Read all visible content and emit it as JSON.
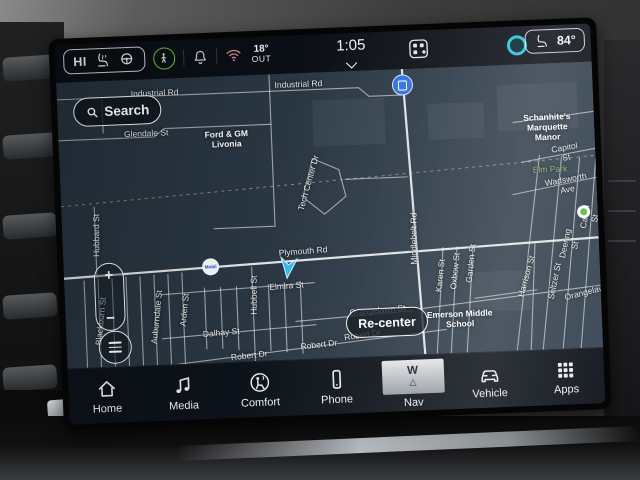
{
  "status_bar": {
    "climate_left_label": "HI",
    "outside_temp": {
      "value": "18°",
      "label": "OUT"
    },
    "time": "1:05",
    "right_temp": "84°",
    "icons": [
      "heated-seat",
      "heated-steering-wheel",
      "pedestrian-alert",
      "notification-bell",
      "wifi",
      "apps-grid",
      "voice-assistant",
      "seat"
    ]
  },
  "map": {
    "search_label": "Search",
    "recenter_label": "Re-center",
    "zoom_in_label": "+",
    "zoom_out_label": "−",
    "pois": [
      {
        "name": "Mobil",
        "type": "gas-station"
      },
      {
        "type": "blue-building-poi",
        "color": "#2e6fe0"
      },
      {
        "type": "green-park-pin",
        "color": "#5bb84a"
      }
    ],
    "colors": {
      "background": "#2b3844",
      "road": "#ffffff",
      "park_text": "#83b271",
      "cursor": "#30b8ef"
    },
    "labels": [
      {
        "t": "Industrial Rd",
        "x": 98,
        "y": 14,
        "r": 0,
        "c": "st"
      },
      {
        "t": "Industrial Rd",
        "x": 242,
        "y": 11,
        "r": 0,
        "c": "st"
      },
      {
        "t": "Glendale St",
        "x": 88,
        "y": 54,
        "r": 0,
        "c": "st"
      },
      {
        "t": "Ford & GM\nLivonia",
        "x": 168,
        "y": 63,
        "r": 0,
        "c": "poi"
      },
      {
        "t": "Hubbard St",
        "x": 34,
        "y": 154,
        "r": -88,
        "c": "st"
      },
      {
        "t": "Tech Center Dr",
        "x": 248,
        "y": 110,
        "r": -72,
        "c": "st"
      },
      {
        "t": "Schanhite's\nMarquette Manor",
        "x": 489,
        "y": 64,
        "r": 0,
        "c": "poi"
      },
      {
        "t": "Capitol St",
        "x": 506,
        "y": 90,
        "r": -8,
        "c": "st"
      },
      {
        "t": "Elm Park",
        "x": 490,
        "y": 106,
        "r": 0,
        "c": "park"
      },
      {
        "t": "Wadsworth Ave",
        "x": 506,
        "y": 122,
        "r": -8,
        "c": "st"
      },
      {
        "t": "Middlebelt Rd",
        "x": 351,
        "y": 170,
        "r": -88,
        "c": "st"
      },
      {
        "t": "Plymouth Rd",
        "x": 240,
        "y": 178,
        "r": -2,
        "c": "st"
      },
      {
        "t": "Elmira St",
        "x": 222,
        "y": 212,
        "r": -2,
        "c": "st"
      },
      {
        "t": "Hubbell St",
        "x": 189,
        "y": 220,
        "r": -88,
        "c": "st"
      },
      {
        "t": "Dalhay St",
        "x": 155,
        "y": 256,
        "r": -3,
        "c": "st"
      },
      {
        "t": "Orangelawn St",
        "x": 312,
        "y": 240,
        "r": -3,
        "c": "st"
      },
      {
        "t": "Orangelawn",
        "x": 522,
        "y": 230,
        "r": -12,
        "c": "st"
      },
      {
        "t": "Robert Dr",
        "x": 182,
        "y": 280,
        "r": -4,
        "c": "st"
      },
      {
        "t": "Robert Dr",
        "x": 252,
        "y": 272,
        "r": -4,
        "c": "st"
      },
      {
        "t": "Robert Dr",
        "x": 296,
        "y": 264,
        "r": -6,
        "c": "st"
      },
      {
        "t": "Blackburn St",
        "x": 35,
        "y": 240,
        "r": -82,
        "c": "st"
      },
      {
        "t": "Auburndale St",
        "x": 91,
        "y": 238,
        "r": -82,
        "c": "st"
      },
      {
        "t": "Arden St",
        "x": 119,
        "y": 232,
        "r": -82,
        "c": "st"
      },
      {
        "t": "Karen St",
        "x": 376,
        "y": 208,
        "r": -82,
        "c": "st"
      },
      {
        "t": "Oxbow St",
        "x": 391,
        "y": 204,
        "r": -82,
        "c": "st"
      },
      {
        "t": "Garden St",
        "x": 407,
        "y": 197,
        "r": -82,
        "c": "st"
      },
      {
        "t": "Harrison St",
        "x": 462,
        "y": 212,
        "r": -72,
        "c": "st"
      },
      {
        "t": "Seltzer St",
        "x": 490,
        "y": 218,
        "r": -76,
        "c": "st"
      },
      {
        "t": "Deering St",
        "x": 507,
        "y": 182,
        "r": -76,
        "c": "st"
      },
      {
        "t": "Cavell St",
        "x": 528,
        "y": 156,
        "r": -78,
        "c": "st"
      },
      {
        "t": "Emerson Middle\nSchool",
        "x": 394,
        "y": 252,
        "r": 0,
        "c": "poi"
      }
    ]
  },
  "nav_bar": {
    "active_item": "Nav",
    "compass_heading": "W",
    "items": [
      {
        "label": "Home"
      },
      {
        "label": "Media"
      },
      {
        "label": "Comfort"
      },
      {
        "label": "Phone"
      },
      {
        "label": "Nav"
      },
      {
        "label": "Vehicle"
      },
      {
        "label": "Apps"
      }
    ]
  }
}
